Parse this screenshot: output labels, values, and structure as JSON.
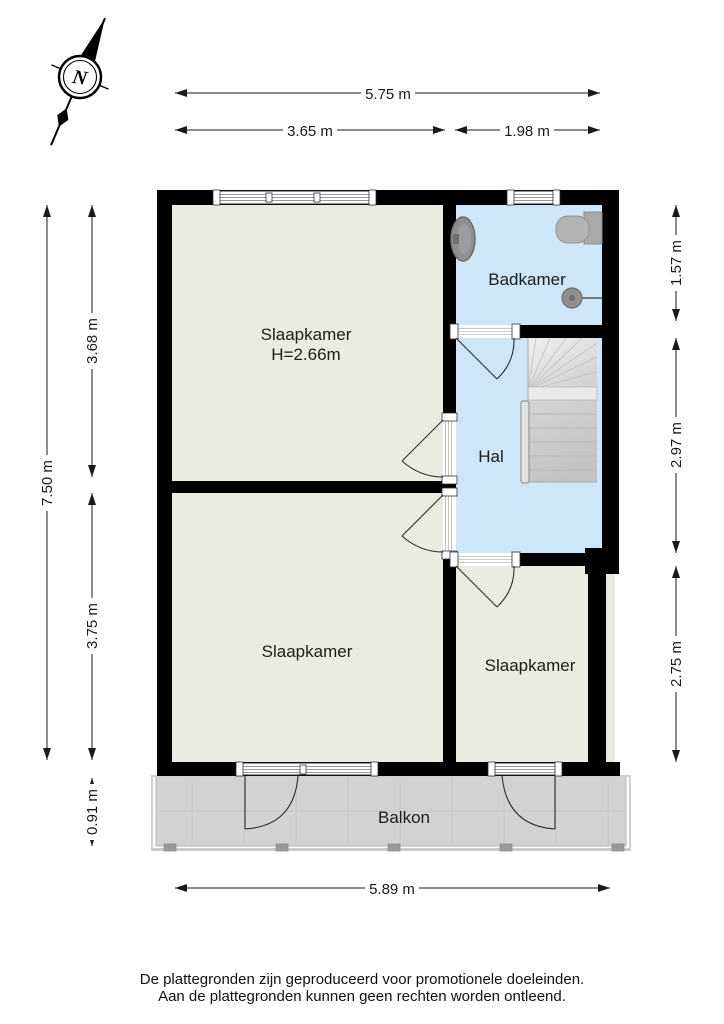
{
  "compass": {
    "north_label": "N"
  },
  "rooms": {
    "bedroom_top": {
      "label": "Slaapkamer",
      "ceiling_height": "H=2.66m"
    },
    "bathroom": {
      "label": "Badkamer"
    },
    "hallway": {
      "label": "Hal"
    },
    "bedroom_bottom_left": {
      "label": "Slaapkamer"
    },
    "bedroom_bottom_right": {
      "label": "Slaapkamer"
    },
    "balcony": {
      "label": "Balkon"
    }
  },
  "dimensions": {
    "top_total": "5.75 m",
    "top_left_section": "3.65 m",
    "top_right_section": "1.98 m",
    "left_total": "7.50 m",
    "left_upper_section": "3.68 m",
    "left_lower_section": "3.75 m",
    "balcony_depth": "0.91 m",
    "right_upper_section": "1.57 m",
    "right_middle_section": "2.97 m",
    "right_lower_section": "2.75 m",
    "bottom_total": "5.89 m"
  },
  "footer": {
    "line1": "De plattegronden zijn geproduceerd voor promotionele doeleinden.",
    "line2": "Aan de plattegronden kunnen geen rechten worden ontleend."
  },
  "colors": {
    "wall": "#000000",
    "room_fill": "#ECEBE1",
    "wet_room_fill": "#CDE7F8",
    "balcony_fill": "#D2D2D2",
    "stairs_fill": "#D8D8D8",
    "fixture_fill": "#8F8F8F",
    "dimension_color": "#1A1A1A"
  }
}
